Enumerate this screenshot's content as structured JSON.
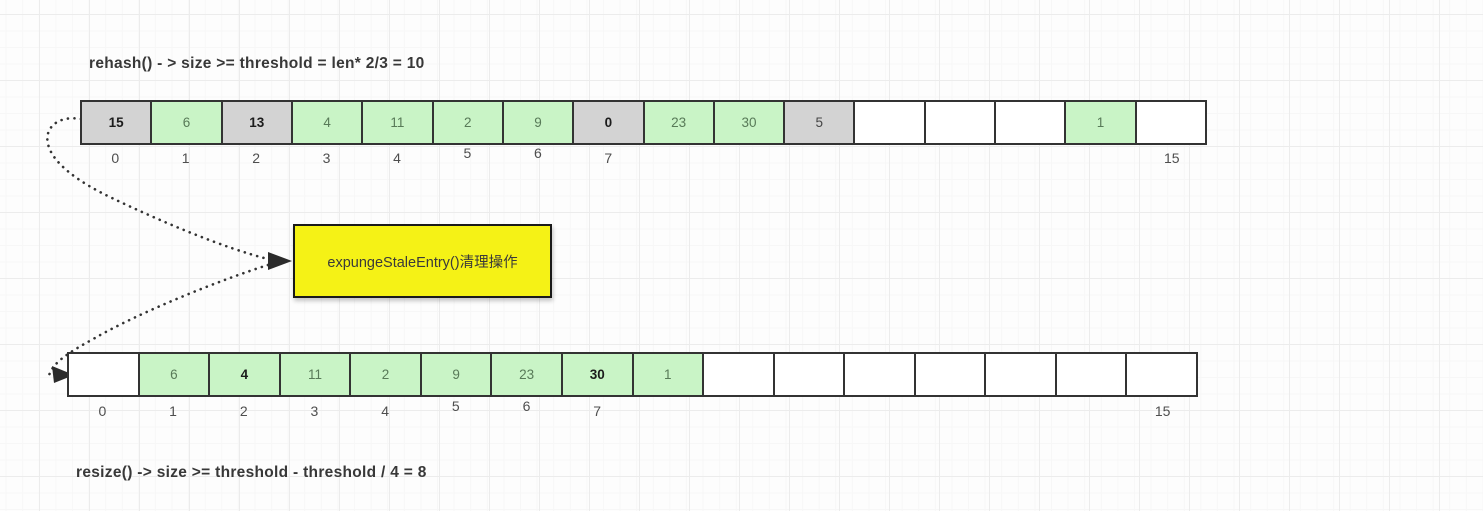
{
  "formulas": {
    "top": "rehash() - > size >= threshold = len* 2/3 = 10",
    "bottom": "resize() -> size >= threshold - threshold / 4 = 8"
  },
  "note_box": {
    "label": "expungeStaleEntry()清理操作"
  },
  "colors": {
    "cell_gray": "#d3d3d3",
    "cell_green": "#c9f4c6",
    "cell_empty": "#ffffff",
    "cell_border": "#333333",
    "note_yellow": "#f5f216",
    "note_border": "#1a1a1a",
    "connector": "#333333",
    "text_dark": "#383838",
    "index_label": "#4e4e4e",
    "grid_major": "#ececec",
    "grid_minor": "#f7f7f7"
  },
  "top_array": {
    "cells": [
      {
        "value": "15",
        "type": "gray",
        "bold": true
      },
      {
        "value": "6",
        "type": "green",
        "bold": false
      },
      {
        "value": "13",
        "type": "gray",
        "bold": true
      },
      {
        "value": "4",
        "type": "green",
        "bold": false
      },
      {
        "value": "11",
        "type": "green",
        "bold": false
      },
      {
        "value": "2",
        "type": "green",
        "bold": false
      },
      {
        "value": "9",
        "type": "green",
        "bold": false
      },
      {
        "value": "0",
        "type": "gray",
        "bold": true
      },
      {
        "value": "23",
        "type": "green",
        "bold": false
      },
      {
        "value": "30",
        "type": "green",
        "bold": false
      },
      {
        "value": "5",
        "type": "gray",
        "bold": false
      },
      {
        "value": "",
        "type": "empty",
        "bold": false
      },
      {
        "value": "",
        "type": "empty",
        "bold": false
      },
      {
        "value": "",
        "type": "empty",
        "bold": false
      },
      {
        "value": "1",
        "type": "green",
        "bold": false
      },
      {
        "value": "",
        "type": "empty",
        "bold": false
      }
    ],
    "index_labels": [
      {
        "text": "0",
        "cell": 0,
        "raised": false
      },
      {
        "text": "1",
        "cell": 1,
        "raised": false
      },
      {
        "text": "2",
        "cell": 2,
        "raised": false
      },
      {
        "text": "3",
        "cell": 3,
        "raised": false
      },
      {
        "text": "4",
        "cell": 4,
        "raised": false
      },
      {
        "text": "5",
        "cell": 5,
        "raised": true
      },
      {
        "text": "6",
        "cell": 6,
        "raised": true
      },
      {
        "text": "7",
        "cell": 7,
        "raised": false
      },
      {
        "text": "15",
        "cell": 15,
        "raised": false
      }
    ]
  },
  "bottom_array": {
    "cells": [
      {
        "value": "",
        "type": "empty",
        "bold": false
      },
      {
        "value": "6",
        "type": "green",
        "bold": false
      },
      {
        "value": "4",
        "type": "green",
        "bold": true
      },
      {
        "value": "11",
        "type": "green",
        "bold": false
      },
      {
        "value": "2",
        "type": "green",
        "bold": false
      },
      {
        "value": "9",
        "type": "green",
        "bold": false
      },
      {
        "value": "23",
        "type": "green",
        "bold": false
      },
      {
        "value": "30",
        "type": "green",
        "bold": true
      },
      {
        "value": "1",
        "type": "green",
        "bold": false
      },
      {
        "value": "",
        "type": "empty",
        "bold": false
      },
      {
        "value": "",
        "type": "empty",
        "bold": false
      },
      {
        "value": "",
        "type": "empty",
        "bold": false
      },
      {
        "value": "",
        "type": "empty",
        "bold": false
      },
      {
        "value": "",
        "type": "empty",
        "bold": false
      },
      {
        "value": "",
        "type": "empty",
        "bold": false
      },
      {
        "value": "",
        "type": "empty",
        "bold": false
      }
    ],
    "index_labels": [
      {
        "text": "0",
        "cell": 0,
        "raised": false
      },
      {
        "text": "1",
        "cell": 1,
        "raised": false
      },
      {
        "text": "2",
        "cell": 2,
        "raised": false
      },
      {
        "text": "3",
        "cell": 3,
        "raised": false
      },
      {
        "text": "4",
        "cell": 4,
        "raised": false
      },
      {
        "text": "5",
        "cell": 5,
        "raised": true
      },
      {
        "text": "6",
        "cell": 6,
        "raised": true
      },
      {
        "text": "7",
        "cell": 7,
        "raised": false
      },
      {
        "text": "15",
        "cell": 15,
        "raised": false
      }
    ]
  }
}
